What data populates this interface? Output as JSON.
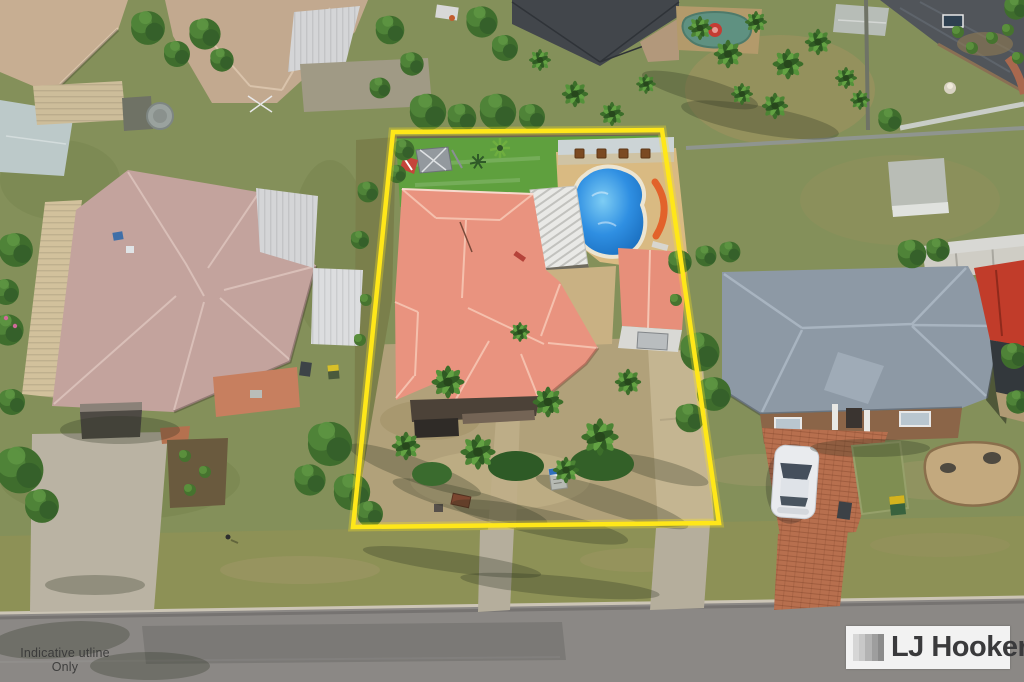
{
  "image": {
    "kind": "aerial real estate photograph",
    "summary": "Drone view of suburban homes; centre property outlined in yellow featuring a salmon hip-roof house, kidney swimming pool, detached garage and palm-filled front yard; LJ Hooker logo bottom right; indicative-outline disclaimer bottom left."
  },
  "overlays": {
    "watermark": {
      "line1": "Indicative utline",
      "line2": "Only"
    },
    "logo": {
      "brand": "LJ Hooker",
      "icon": "gradient-stripe-square-icon"
    }
  },
  "palette": {
    "boundary_yellow": "#ffe719",
    "subject_roof_salmon": "#e9937f",
    "shed_roof_salmon": "#e78f7a",
    "left_roof_mauve": "#c3a39d",
    "right_roof_gray": "#8d99a5",
    "far_right_roof_red": "#c13c2a",
    "brick_driveway": "#b76f4e",
    "street_gray": "#8b8885",
    "lawn_green": "#84905a",
    "backyard_green": "#5fa03e",
    "front_dirt": "#b1a17a",
    "pool_blue": "#1668b8",
    "pool_paving": "#d9ba82",
    "logo_background": "#f2f2f2",
    "logo_text": "#3a3a3c",
    "watermark_text": "#343434"
  },
  "scene": {
    "subject_property": {
      "highlight": "yellow boundary outline",
      "features": [
        "salmon hip-roof house",
        "kidney-shaped swimming pool",
        "orange pool slide",
        "white pergola",
        "detached garage with salmon roof",
        "rear lawn with play set",
        "palm trees in front yard",
        "concrete driveway",
        "small signboard"
      ]
    },
    "left_neighbour": [
      "large mauve hip-roof house",
      "cream carport awning",
      "wheelie bins",
      "wide concrete driveway",
      "dark mulch garden bed"
    ],
    "right_neighbour": [
      "blue-grey hip-roof house",
      "brick portico with white columns",
      "red-brick driveway",
      "white car",
      "wheelie bins",
      "rock garden bed",
      "backyard shed"
    ],
    "street": [
      "asphalt road",
      "kerb line",
      "grass verge",
      "driveway aprons"
    ],
    "background": [
      "beige neighbouring rooftops",
      "charcoal pyramid roof",
      "green pond with red ring",
      "garden sheds",
      "water tank",
      "palm clusters",
      "timber fences"
    ]
  }
}
